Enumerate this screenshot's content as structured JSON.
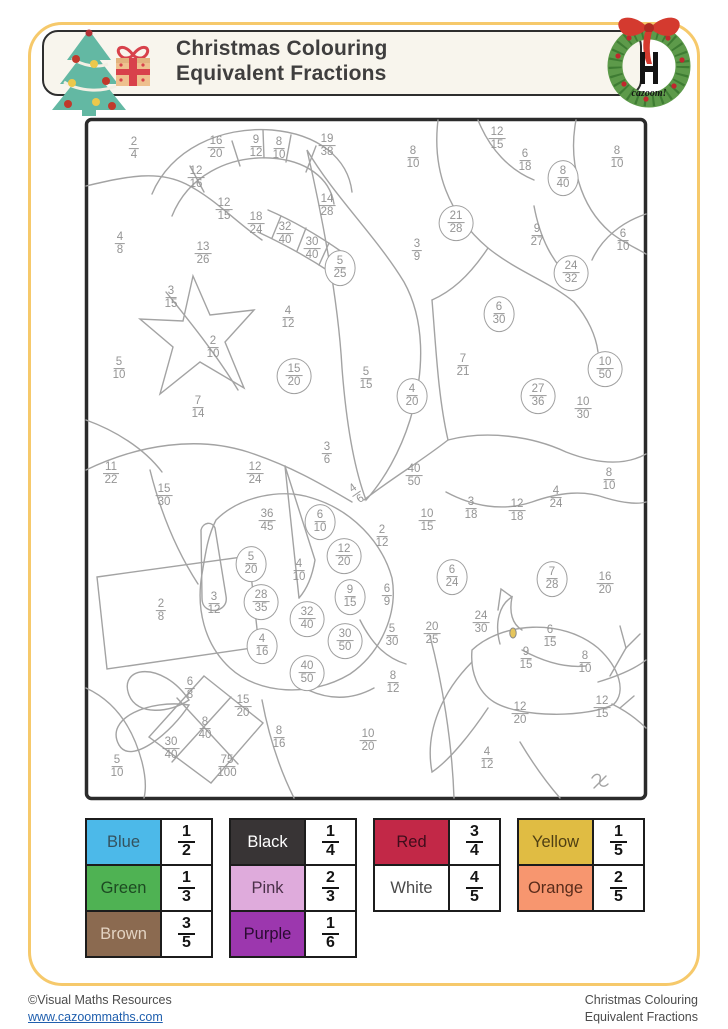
{
  "header": {
    "title_line1": "Christmas Colouring",
    "title_line2": "Equivalent Fractions",
    "logo_text": "cazoom!"
  },
  "footer": {
    "copyright": "©Visual Maths Resources",
    "website": "www.cazoommaths.com",
    "doc_line1": "Christmas Colouring",
    "doc_line2": "Equivalent Fractions"
  },
  "key": {
    "tables": [
      {
        "rows": [
          {
            "label": "Blue",
            "hex": "#4cb9e9",
            "text_hex": "#34525e",
            "n": "1",
            "d": "2"
          },
          {
            "label": "Green",
            "hex": "#4fb253",
            "text_hex": "#1d4a22",
            "n": "1",
            "d": "3"
          },
          {
            "label": "Brown",
            "hex": "#8b6a50",
            "text_hex": "#e3d3c2",
            "n": "3",
            "d": "5"
          }
        ]
      },
      {
        "rows": [
          {
            "label": "Black",
            "hex": "#383435",
            "text_hex": "#ffffff",
            "n": "1",
            "d": "4"
          },
          {
            "label": "Pink",
            "hex": "#dfabdc",
            "text_hex": "#4b3049",
            "n": "2",
            "d": "3"
          },
          {
            "label": "Purple",
            "hex": "#9c37ae",
            "text_hex": "#2a0b31",
            "n": "1",
            "d": "6"
          }
        ]
      },
      {
        "rows": [
          {
            "label": "Red",
            "hex": "#c22847",
            "text_hex": "#3f0d1b",
            "n": "3",
            "d": "4"
          },
          {
            "label": "White",
            "hex": "#ffffff",
            "text_hex": "#4a4a4a",
            "n": "4",
            "d": "5"
          }
        ]
      },
      {
        "rows": [
          {
            "label": "Yellow",
            "hex": "#e0bc43",
            "text_hex": "#4f3f13",
            "n": "1",
            "d": "5"
          },
          {
            "label": "Orange",
            "hex": "#f7966f",
            "text_hex": "#5a2c1a",
            "n": "2",
            "d": "5"
          }
        ]
      }
    ]
  },
  "puzzle": {
    "fractions": [
      {
        "n": "2",
        "d": "4",
        "x": 134,
        "y": 149
      },
      {
        "n": "16",
        "d": "20",
        "x": 216,
        "y": 148
      },
      {
        "n": "9",
        "d": "12",
        "x": 256,
        "y": 147
      },
      {
        "n": "8",
        "d": "10",
        "x": 279,
        "y": 149
      },
      {
        "n": "19",
        "d": "38",
        "x": 327,
        "y": 146
      },
      {
        "n": "8",
        "d": "10",
        "x": 413,
        "y": 158
      },
      {
        "n": "12",
        "d": "15",
        "x": 497,
        "y": 139
      },
      {
        "n": "6",
        "d": "18",
        "x": 525,
        "y": 161
      },
      {
        "n": "8",
        "d": "40",
        "x": 563,
        "y": 178,
        "c": true
      },
      {
        "n": "8",
        "d": "10",
        "x": 617,
        "y": 158
      },
      {
        "n": "12",
        "d": "16",
        "x": 196,
        "y": 178
      },
      {
        "n": "12",
        "d": "15",
        "x": 224,
        "y": 210
      },
      {
        "n": "18",
        "d": "24",
        "x": 256,
        "y": 224
      },
      {
        "n": "14",
        "d": "28",
        "x": 327,
        "y": 206
      },
      {
        "n": "21",
        "d": "28",
        "x": 456,
        "y": 223,
        "c": true
      },
      {
        "n": "9",
        "d": "27",
        "x": 537,
        "y": 236
      },
      {
        "n": "6",
        "d": "10",
        "x": 623,
        "y": 241
      },
      {
        "n": "4",
        "d": "8",
        "x": 120,
        "y": 244
      },
      {
        "n": "13",
        "d": "26",
        "x": 203,
        "y": 254
      },
      {
        "n": "32",
        "d": "40",
        "x": 285,
        "y": 234
      },
      {
        "n": "30",
        "d": "40",
        "x": 312,
        "y": 249
      },
      {
        "n": "5",
        "d": "25",
        "x": 340,
        "y": 268,
        "c": true
      },
      {
        "n": "3",
        "d": "9",
        "x": 417,
        "y": 251
      },
      {
        "n": "24",
        "d": "32",
        "x": 571,
        "y": 273,
        "c": true
      },
      {
        "n": "3",
        "d": "15",
        "x": 171,
        "y": 298
      },
      {
        "n": "6",
        "d": "30",
        "x": 499,
        "y": 314,
        "c": true
      },
      {
        "n": "4",
        "d": "12",
        "x": 288,
        "y": 318
      },
      {
        "n": "2",
        "d": "10",
        "x": 213,
        "y": 348
      },
      {
        "n": "5",
        "d": "10",
        "x": 119,
        "y": 369
      },
      {
        "n": "7",
        "d": "21",
        "x": 463,
        "y": 366
      },
      {
        "n": "15",
        "d": "20",
        "x": 294,
        "y": 376,
        "c": true
      },
      {
        "n": "5",
        "d": "15",
        "x": 366,
        "y": 379
      },
      {
        "n": "4",
        "d": "20",
        "x": 412,
        "y": 396,
        "c": true
      },
      {
        "n": "10",
        "d": "50",
        "x": 605,
        "y": 369,
        "c": true
      },
      {
        "n": "27",
        "d": "36",
        "x": 538,
        "y": 396,
        "c": true
      },
      {
        "n": "7",
        "d": "14",
        "x": 198,
        "y": 408
      },
      {
        "n": "10",
        "d": "30",
        "x": 583,
        "y": 409
      },
      {
        "n": "3",
        "d": "6",
        "x": 327,
        "y": 454
      },
      {
        "n": "11",
        "d": "22",
        "x": 111,
        "y": 474
      },
      {
        "n": "12",
        "d": "24",
        "x": 255,
        "y": 474
      },
      {
        "n": "40",
        "d": "50",
        "x": 414,
        "y": 476
      },
      {
        "n": "15",
        "d": "30",
        "x": 164,
        "y": 496
      },
      {
        "n": "4",
        "d": "6",
        "x": 357,
        "y": 494,
        "r": -35
      },
      {
        "n": "8",
        "d": "10",
        "x": 609,
        "y": 480
      },
      {
        "n": "36",
        "d": "45",
        "x": 267,
        "y": 521
      },
      {
        "n": "6",
        "d": "10",
        "x": 320,
        "y": 522,
        "c": true
      },
      {
        "n": "10",
        "d": "15",
        "x": 427,
        "y": 521
      },
      {
        "n": "3",
        "d": "18",
        "x": 471,
        "y": 509
      },
      {
        "n": "12",
        "d": "18",
        "x": 517,
        "y": 511
      },
      {
        "n": "4",
        "d": "24",
        "x": 556,
        "y": 498
      },
      {
        "n": "2",
        "d": "12",
        "x": 382,
        "y": 537
      },
      {
        "n": "12",
        "d": "20",
        "x": 344,
        "y": 556,
        "c": true
      },
      {
        "n": "5",
        "d": "20",
        "x": 251,
        "y": 564,
        "c": true
      },
      {
        "n": "4",
        "d": "10",
        "x": 299,
        "y": 571
      },
      {
        "n": "6",
        "d": "24",
        "x": 452,
        "y": 577,
        "c": true
      },
      {
        "n": "7",
        "d": "28",
        "x": 552,
        "y": 579,
        "c": true
      },
      {
        "n": "16",
        "d": "20",
        "x": 605,
        "y": 584
      },
      {
        "n": "9",
        "d": "15",
        "x": 350,
        "y": 597,
        "c": true
      },
      {
        "n": "6",
        "d": "9",
        "x": 387,
        "y": 596
      },
      {
        "n": "28",
        "d": "35",
        "x": 261,
        "y": 602,
        "c": true
      },
      {
        "n": "3",
        "d": "12",
        "x": 214,
        "y": 604
      },
      {
        "n": "2",
        "d": "8",
        "x": 161,
        "y": 611
      },
      {
        "n": "32",
        "d": "40",
        "x": 307,
        "y": 619,
        "c": true
      },
      {
        "n": "24",
        "d": "30",
        "x": 481,
        "y": 623
      },
      {
        "n": "20",
        "d": "25",
        "x": 432,
        "y": 634
      },
      {
        "n": "5",
        "d": "30",
        "x": 392,
        "y": 636
      },
      {
        "n": "6",
        "d": "15",
        "x": 550,
        "y": 637
      },
      {
        "n": "4",
        "d": "16",
        "x": 262,
        "y": 646,
        "c": true
      },
      {
        "n": "30",
        "d": "50",
        "x": 345,
        "y": 641,
        "c": true
      },
      {
        "n": "9",
        "d": "15",
        "x": 526,
        "y": 659
      },
      {
        "n": "8",
        "d": "10",
        "x": 585,
        "y": 663
      },
      {
        "n": "40",
        "d": "50",
        "x": 307,
        "y": 673,
        "c": true
      },
      {
        "n": "8",
        "d": "12",
        "x": 393,
        "y": 683
      },
      {
        "n": "6",
        "d": "8",
        "x": 190,
        "y": 689
      },
      {
        "n": "15",
        "d": "20",
        "x": 243,
        "y": 707
      },
      {
        "n": "12",
        "d": "15",
        "x": 602,
        "y": 708
      },
      {
        "n": "12",
        "d": "20",
        "x": 520,
        "y": 714
      },
      {
        "n": "8",
        "d": "40",
        "x": 205,
        "y": 729
      },
      {
        "n": "8",
        "d": "16",
        "x": 279,
        "y": 738
      },
      {
        "n": "10",
        "d": "20",
        "x": 368,
        "y": 741
      },
      {
        "n": "30",
        "d": "40",
        "x": 171,
        "y": 749
      },
      {
        "n": "4",
        "d": "12",
        "x": 487,
        "y": 759
      },
      {
        "n": "75",
        "d": "100",
        "x": 227,
        "y": 767
      },
      {
        "n": "5",
        "d": "10",
        "x": 117,
        "y": 767
      }
    ]
  }
}
